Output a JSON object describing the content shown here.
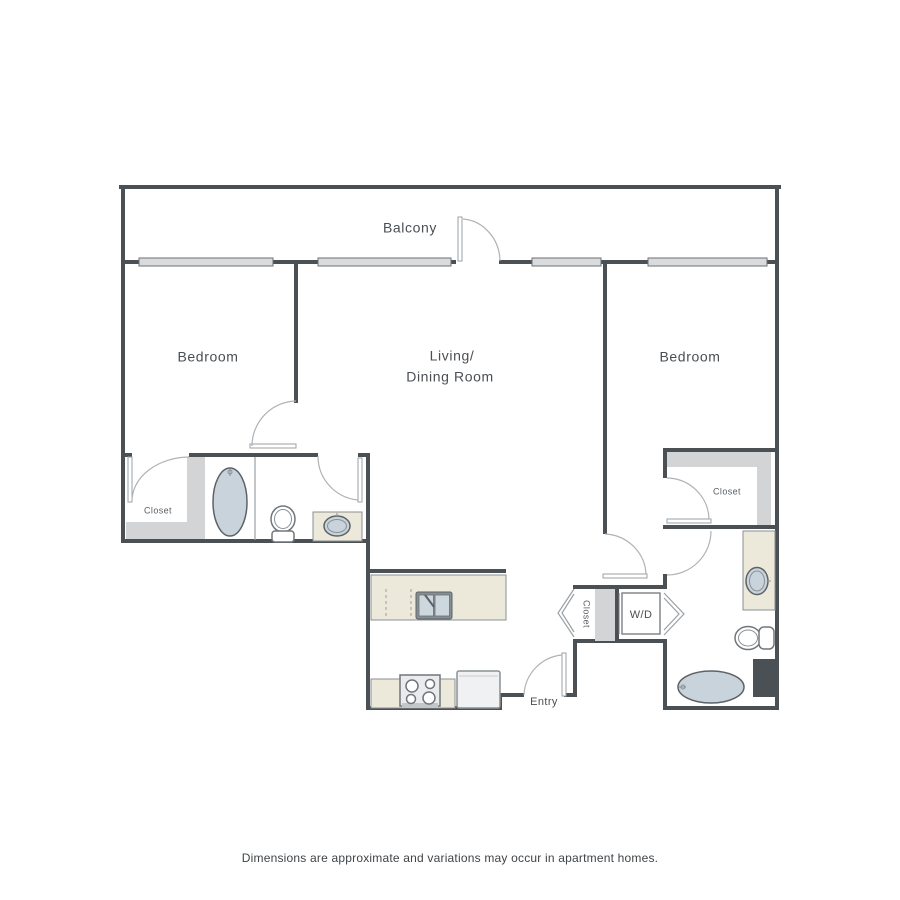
{
  "labels": {
    "balcony": "Balcony",
    "bedroom_left": "Bedroom",
    "living_line1": "Living/",
    "living_line2": "Dining Room",
    "bedroom_right": "Bedroom",
    "closet_left": "Closet",
    "closet_right": "Closet",
    "closet_entry": "Closet",
    "washer_dryer": "W/D",
    "entry": "Entry",
    "disclaimer": "Dimensions are approximate and variations may occur in apartment homes."
  },
  "colors": {
    "wall": "#4b5055",
    "thin_line": "#9aa0a4",
    "window_fill": "#d9dbdd",
    "shelf_gray": "#d2d4d6",
    "counter_beige": "#ede9da",
    "water_blue": "#c9d3db",
    "fixture_outline": "#5b6368",
    "label_text": "#4a4f54",
    "background": "#ffffff"
  }
}
